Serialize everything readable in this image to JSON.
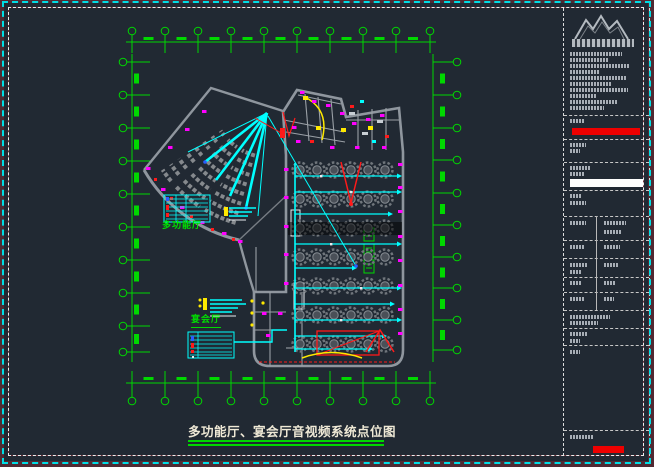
{
  "drawing": {
    "title": "多功能厅、宴会厅音视频系统点位图",
    "rooms": {
      "multifunction_hall": "多功能厅",
      "banquet_hall": "宴会厅"
    }
  },
  "title_block": {
    "logo_icon": "company-logo-mountains-icon",
    "highlight_bars": [
      "red-bar-top",
      "white-bar",
      "red-bar-bottom"
    ]
  },
  "icons": [
    "company-logo-mountains-icon"
  ],
  "colors": {
    "background": "#212933",
    "outer_frame_maroon": "#502a33",
    "border_cyan_dashed": "#00dde4",
    "border_white_dashed": "#ededed",
    "grid_green": "#00d800",
    "room_label_green": "#00e000",
    "wall_gray": "#8f969e",
    "cable_cyan": "#00ffff",
    "device_magenta": "#ff00ff",
    "alert_red": "#ff1a1a",
    "equipment_yellow": "#ffe900",
    "title_text": "#efe9d6",
    "titleblock_red_bar": "#ee0000",
    "titleblock_white_bar": "#ffffff"
  }
}
